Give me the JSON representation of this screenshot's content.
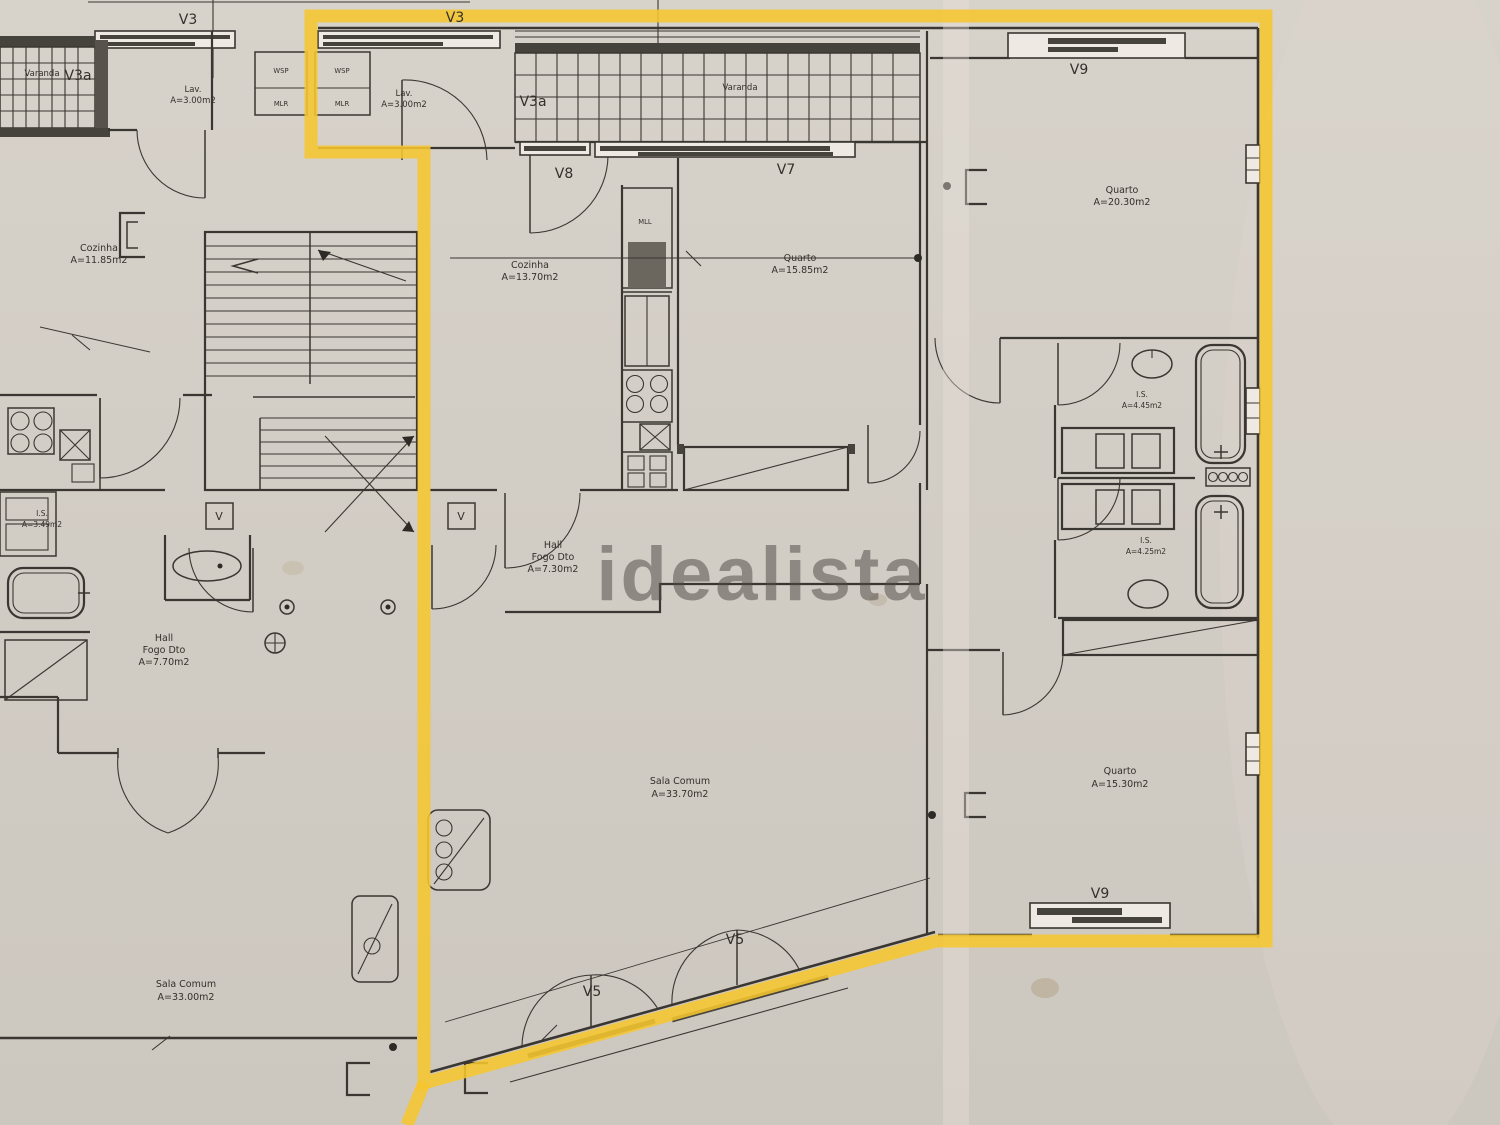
{
  "watermark": "idealista",
  "plan": {
    "left_unit": {
      "balcony": {
        "name": "Varanda",
        "code": "V3a"
      },
      "window_top": "V3",
      "laundry": {
        "name": "Lav.",
        "area": "A=3.00m2"
      },
      "duct_top": "WSP",
      "duct_bottom": "MLR",
      "kitchen": {
        "name": "Cozinha",
        "area": "A=11.85m2"
      },
      "wc": {
        "name": "I.S.",
        "area": "A=3.49m2"
      },
      "hall": {
        "name": "Hall",
        "unit": "Fogo Dto",
        "area": "A=7.70m2"
      },
      "living": {
        "name": "Sala Comum",
        "area": "A=33.00m2"
      },
      "vent": "V"
    },
    "unit": {
      "window_top": "V3",
      "duct_top": "WSP",
      "duct_bottom": "MLR",
      "laundry": {
        "name": "Lav.",
        "area": "A=3.00m2"
      },
      "balcony": {
        "name": "Varanda",
        "code": "V3a"
      },
      "kitchen": {
        "name": "Cozinha",
        "area": "A=13.70m2",
        "appliance": "MLL"
      },
      "kitchen_door": "V8",
      "bedroom1": {
        "name": "Quarto",
        "area": "A=15.85m2",
        "window": "V7"
      },
      "bedroom2": {
        "name": "Quarto",
        "area": "A=20.30m2",
        "window": "V9"
      },
      "bath1": {
        "name": "I.S.",
        "area": "A=4.45m2"
      },
      "bath2": {
        "name": "I.S.",
        "area": "A=4.25m2"
      },
      "hall": {
        "name": "Hall",
        "unit": "Fogo Dto",
        "area": "A=7.30m2"
      },
      "living": {
        "name": "Sala Comum",
        "area": "A=33.70m2",
        "door1": "V5",
        "door2": "V5"
      },
      "bedroom3": {
        "name": "Quarto",
        "area": "A=15.30m2",
        "window": "V9"
      },
      "vent": "V"
    }
  }
}
